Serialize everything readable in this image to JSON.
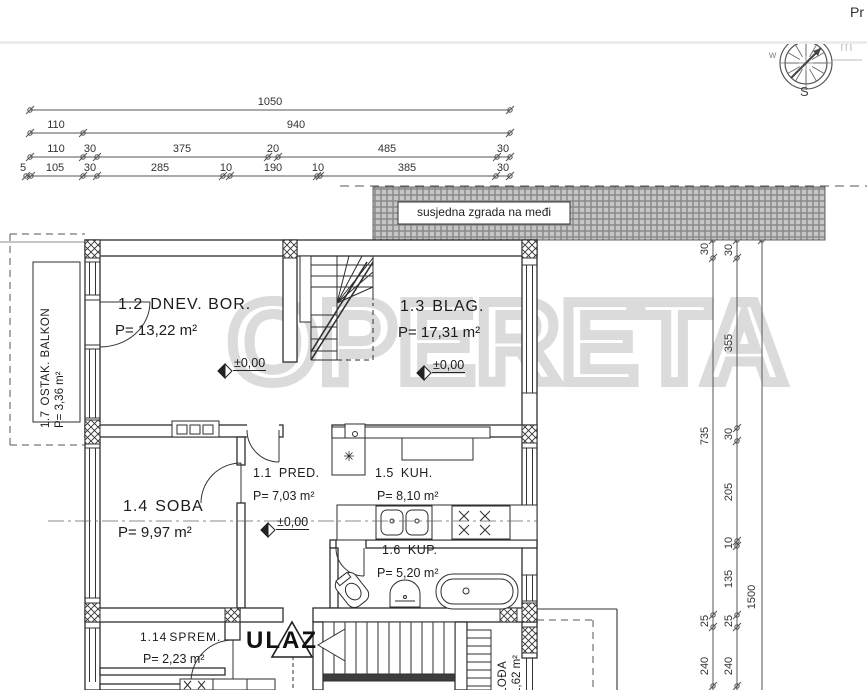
{
  "header": {
    "partial_link": "Pr"
  },
  "compass": {
    "south": "S",
    "west": "w"
  },
  "watermark": {
    "text": "OPERETA",
    "fragment": "m"
  },
  "site": {
    "neighbor_label": "susjedna zgrada na međi"
  },
  "entrance": {
    "label": "ULAZ"
  },
  "level_marker": "±0,00",
  "rooms": {
    "living": {
      "code": "1.2",
      "name": "DNEV. BOR.",
      "area": "P= 13,22 m²"
    },
    "dining": {
      "code": "1.3",
      "name": "BLAG.",
      "area": "P= 17,31 m²"
    },
    "balcony": {
      "code": "1.7",
      "name": "OSTAK. BALKON",
      "area": "P= 3,36 m²"
    },
    "hall": {
      "code": "1.1",
      "name": "PRED.",
      "area": "P= 7,03 m²"
    },
    "kitchen": {
      "code": "1.5",
      "name": "KUH.",
      "area": "P= 8,10 m²"
    },
    "room": {
      "code": "1.4",
      "name": "SOBA",
      "area": "P= 9,97 m²"
    },
    "bath": {
      "code": "1.6",
      "name": "KUP.",
      "area": "P= 5,20 m²"
    },
    "storage": {
      "code": "1.14",
      "name": "SPREM.",
      "area": "P= 2,23 m²"
    },
    "loggia": {
      "name": "LOĐA",
      "area": "1,62 m²"
    }
  },
  "dims": {
    "row1": [
      "1050"
    ],
    "row2": [
      "110",
      "940"
    ],
    "row3": [
      "110",
      "30",
      "375",
      "20",
      "485",
      "30"
    ],
    "row4": [
      "5",
      "105",
      "30",
      "285",
      "10",
      "190",
      "10",
      "385",
      "30"
    ],
    "right_a": [
      "30",
      "735",
      "25",
      "240"
    ],
    "right_b": [
      "30",
      "355",
      "30",
      "205",
      "10",
      "135",
      "25",
      "240"
    ],
    "right_c": [
      "1500"
    ]
  }
}
